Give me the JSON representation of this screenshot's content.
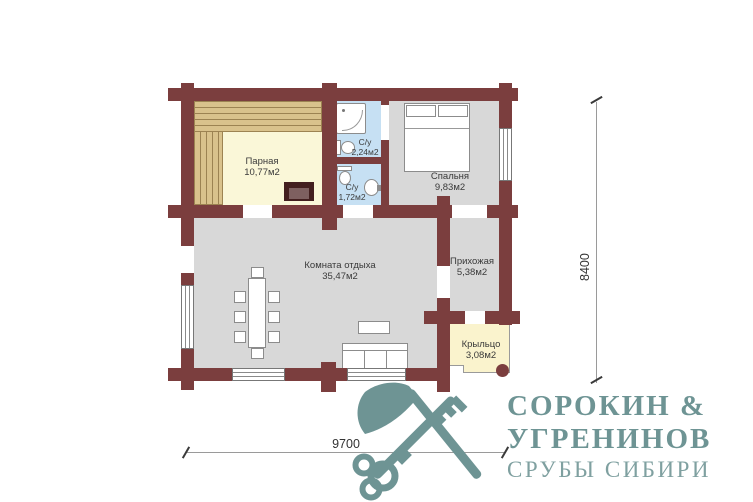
{
  "rooms": {
    "parnaya": {
      "name": "Парная",
      "area": "10,77м2"
    },
    "su_top": {
      "name": "С/у",
      "area": "2,24м2"
    },
    "su_bottom": {
      "name": "С/у",
      "area": "1,72м2"
    },
    "bedroom": {
      "name": "Спальня",
      "area": "9,83м2"
    },
    "lounge": {
      "name": "Комната отдыха",
      "area": "35,47м2"
    },
    "hallway": {
      "name": "Прихожая",
      "area": "5,38м2"
    },
    "porch": {
      "name": "Крыльцо",
      "area": "3,08м2"
    }
  },
  "dimensions": {
    "bottom": "9700",
    "right": "8400"
  },
  "logo": {
    "line1": "СОРОКИН &",
    "line2": "УГРЕНИНОВ",
    "line3": "СРУБЫ СИБИРИ"
  },
  "colors": {
    "wall": "#7B3E3E",
    "floor": "#D8D8D8",
    "sauna": "#FAF7D8",
    "wet": "#C6E0F3",
    "porch": "#FAF3CD",
    "bench": "#D9C28C",
    "bench_line": "#9C8352",
    "label": "#3A3A3A",
    "dim_line": "#9A9A9A",
    "logo": "#6E9494",
    "logo_light": "#7FA0A0"
  }
}
